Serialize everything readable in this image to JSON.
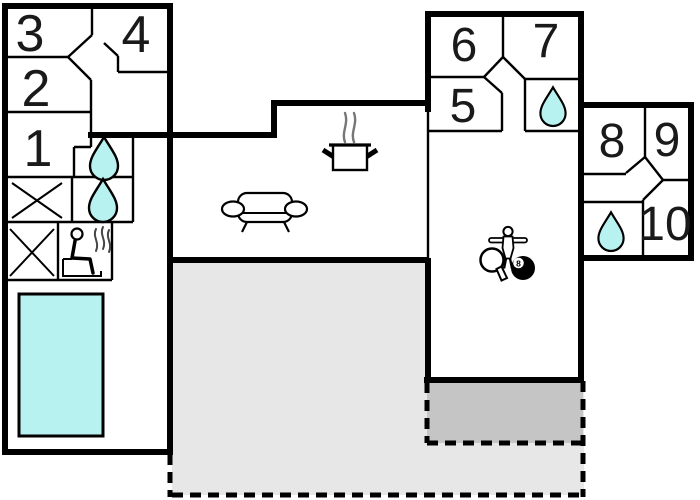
{
  "floorplan": {
    "colors": {
      "wall": "#000000",
      "water": "#b8f2f0",
      "terrace": "#e7e7e7",
      "terrace_covered": "#c5c5c5",
      "background": "#ffffff",
      "steam": "#777777"
    },
    "rooms": [
      {
        "label": "1"
      },
      {
        "label": "2"
      },
      {
        "label": "3"
      },
      {
        "label": "4"
      },
      {
        "label": "5"
      },
      {
        "label": "6"
      },
      {
        "label": "7"
      },
      {
        "label": "8"
      },
      {
        "label": "9"
      },
      {
        "label": "10"
      }
    ],
    "game_room": {
      "billiard_ball_label": "8"
    },
    "legend": {
      "icons": [
        "shower-drop",
        "crossed-square",
        "sauna",
        "swimming-pool",
        "sofa",
        "cooking-pot",
        "foosball-player",
        "table-tennis-paddle",
        "billiard-ball"
      ]
    }
  }
}
